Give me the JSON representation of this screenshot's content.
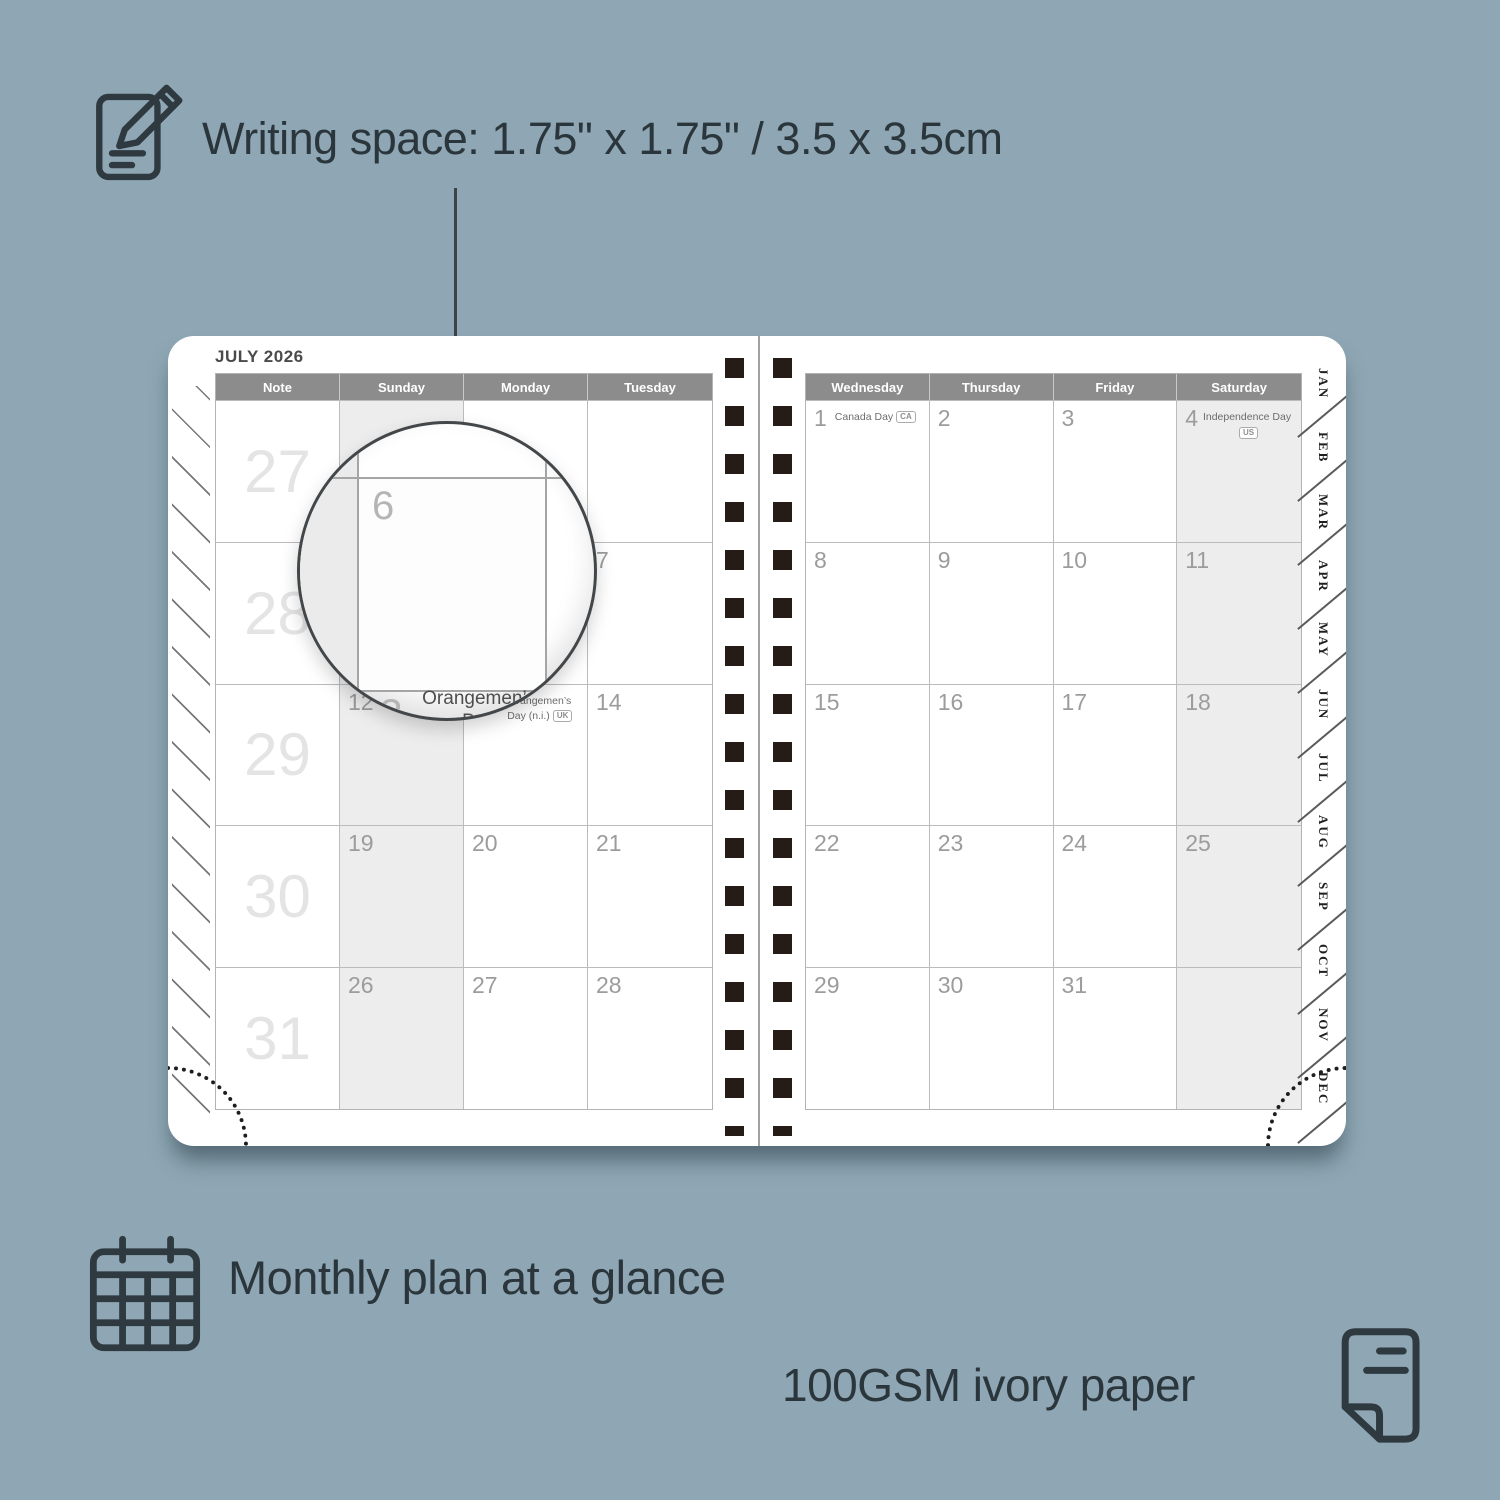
{
  "colors": {
    "background": "#8fa7b4",
    "accent_text": "#2a363c",
    "calendar_header": "#8c8c8c",
    "shaded_column": "#ededed",
    "binding_holes": "#251c18"
  },
  "features": {
    "writing_space": {
      "icon": "notepad-pencil-icon",
      "label": "Writing space: 1.75\" x 1.75\" / 3.5 x 3.5cm"
    },
    "monthly_plan": {
      "icon": "calendar-grid-icon",
      "label": "Monthly plan at a glance"
    },
    "paper": {
      "icon": "paper-sheet-icon",
      "label": "100GSM ivory paper"
    }
  },
  "planner": {
    "title": "JULY 2026",
    "left_page": {
      "headers": [
        "Note",
        "Sunday",
        "Monday",
        "Tuesday"
      ],
      "cells": [
        {
          "wk": "27",
          "num": "",
          "holiday": "",
          "badge": ""
        },
        {
          "wk": "",
          "num": "",
          "holiday": "",
          "badge": ""
        },
        {
          "wk": "",
          "num": "",
          "holiday": "",
          "badge": ""
        },
        {
          "wk": "",
          "num": "",
          "holiday": "",
          "badge": ""
        },
        {
          "wk": "28",
          "num": "",
          "holiday": "",
          "badge": ""
        },
        {
          "wk": "",
          "num": "5",
          "holiday": "",
          "badge": ""
        },
        {
          "wk": "",
          "num": "6",
          "holiday": "",
          "badge": ""
        },
        {
          "wk": "",
          "num": "7",
          "holiday": "",
          "badge": ""
        },
        {
          "wk": "29",
          "num": "",
          "holiday": "",
          "badge": ""
        },
        {
          "wk": "",
          "num": "12",
          "holiday": "",
          "badge": ""
        },
        {
          "wk": "",
          "num": "13",
          "holiday": "Orangemen’s Day (n.i.)",
          "badge": "UK"
        },
        {
          "wk": "",
          "num": "14",
          "holiday": "",
          "badge": ""
        },
        {
          "wk": "30",
          "num": "",
          "holiday": "",
          "badge": ""
        },
        {
          "wk": "",
          "num": "19",
          "holiday": "",
          "badge": ""
        },
        {
          "wk": "",
          "num": "20",
          "holiday": "",
          "badge": ""
        },
        {
          "wk": "",
          "num": "21",
          "holiday": "",
          "badge": ""
        },
        {
          "wk": "31",
          "num": "",
          "holiday": "",
          "badge": ""
        },
        {
          "wk": "",
          "num": "26",
          "holiday": "",
          "badge": ""
        },
        {
          "wk": "",
          "num": "27",
          "holiday": "",
          "badge": ""
        },
        {
          "wk": "",
          "num": "28",
          "holiday": "",
          "badge": ""
        }
      ]
    },
    "right_page": {
      "headers": [
        "Wednesday",
        "Thursday",
        "Friday",
        "Saturday"
      ],
      "cells": [
        {
          "wk": "",
          "num": "1",
          "holiday": "Canada Day",
          "badge": "CA"
        },
        {
          "wk": "",
          "num": "2",
          "holiday": "",
          "badge": ""
        },
        {
          "wk": "",
          "num": "3",
          "holiday": "",
          "badge": ""
        },
        {
          "wk": "",
          "num": "4",
          "holiday": "Independence Day",
          "badge": "US"
        },
        {
          "wk": "",
          "num": "8",
          "holiday": "",
          "badge": ""
        },
        {
          "wk": "",
          "num": "9",
          "holiday": "",
          "badge": ""
        },
        {
          "wk": "",
          "num": "10",
          "holiday": "",
          "badge": ""
        },
        {
          "wk": "",
          "num": "11",
          "holiday": "",
          "badge": ""
        },
        {
          "wk": "",
          "num": "15",
          "holiday": "",
          "badge": ""
        },
        {
          "wk": "",
          "num": "16",
          "holiday": "",
          "badge": ""
        },
        {
          "wk": "",
          "num": "17",
          "holiday": "",
          "badge": ""
        },
        {
          "wk": "",
          "num": "18",
          "holiday": "",
          "badge": ""
        },
        {
          "wk": "",
          "num": "22",
          "holiday": "",
          "badge": ""
        },
        {
          "wk": "",
          "num": "23",
          "holiday": "",
          "badge": ""
        },
        {
          "wk": "",
          "num": "24",
          "holiday": "",
          "badge": ""
        },
        {
          "wk": "",
          "num": "25",
          "holiday": "",
          "badge": ""
        },
        {
          "wk": "",
          "num": "29",
          "holiday": "",
          "badge": ""
        },
        {
          "wk": "",
          "num": "30",
          "holiday": "",
          "badge": ""
        },
        {
          "wk": "",
          "num": "31",
          "holiday": "",
          "badge": ""
        },
        {
          "wk": "",
          "num": "",
          "holiday": "",
          "badge": ""
        }
      ]
    },
    "month_tabs": [
      "JAN",
      "FEB",
      "MAR",
      "APR",
      "MAY",
      "JUN",
      "JUL",
      "AUG",
      "SEP",
      "OCT",
      "NOV",
      "DEC"
    ],
    "magnifier": {
      "day_number": "6",
      "next_week_day": "13",
      "holiday_line1": "Orangemen’s Day",
      "holiday_line2": "(n.i.)",
      "holiday_badge": "UK"
    }
  }
}
